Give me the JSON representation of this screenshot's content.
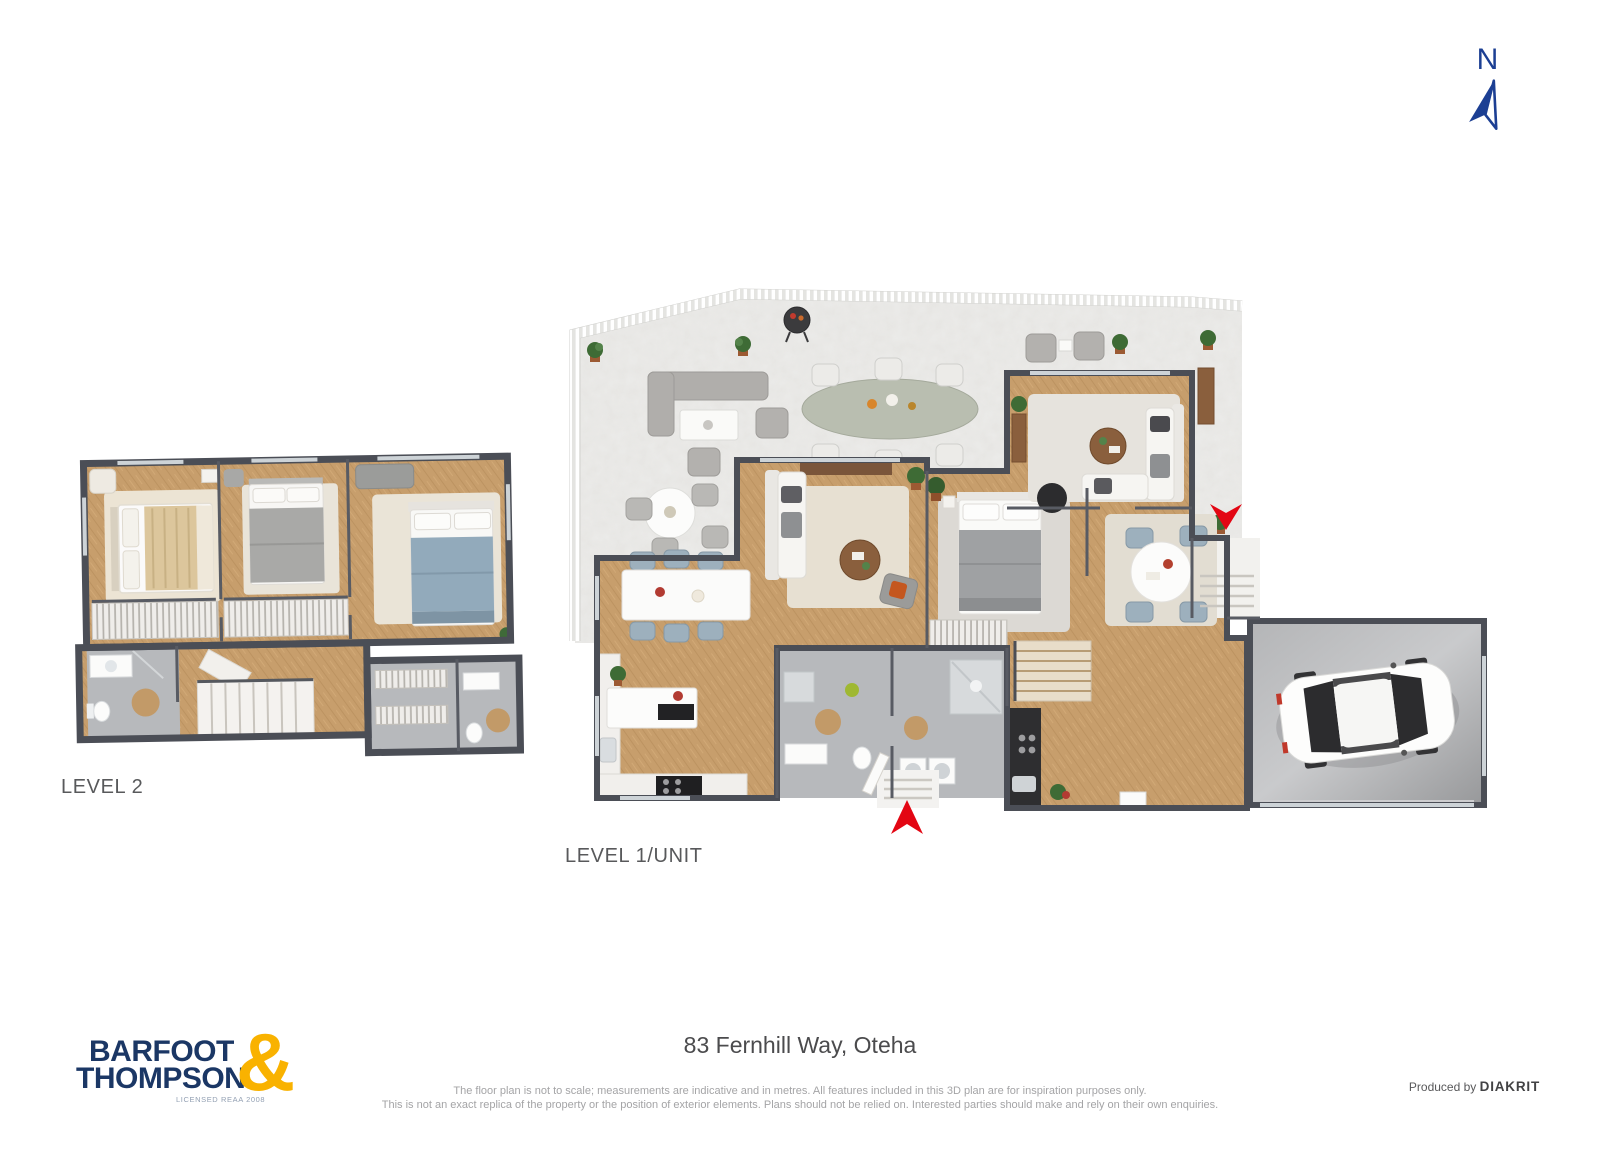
{
  "compass": {
    "label": "N",
    "color": "#1c3f93"
  },
  "plans": {
    "level2": {
      "label": "LEVEL 2"
    },
    "level1": {
      "label": "LEVEL 1/UNIT"
    }
  },
  "footer": {
    "address": "83 Fernhill Way, Oteha",
    "disclaimer_line1": "The floor plan is not to scale; measurements are indicative and in metres. All features included in this 3D plan are for inspiration purposes only.",
    "disclaimer_line2": "This is not an exact replica of the property or the position of exterior elements. Plans should not be relied on. Interested parties should make and rely on their own enquiries.",
    "produced_by_label": "Produced by",
    "producer_name": "DIAKRIT",
    "logo": {
      "line1": "BARFOOT",
      "line2": "THOMPSON",
      "ampersand": "&",
      "license": "LICENSED REAA 2008",
      "navy": "#1b3765",
      "yellow": "#f9b200"
    }
  },
  "colors": {
    "wall": "#4b4e56",
    "wood_floor": "#c79e6c",
    "terrace_floor": "#e3e2df",
    "bath_floor": "#b7b9bc",
    "entry_arrow_red": "#e30613"
  }
}
